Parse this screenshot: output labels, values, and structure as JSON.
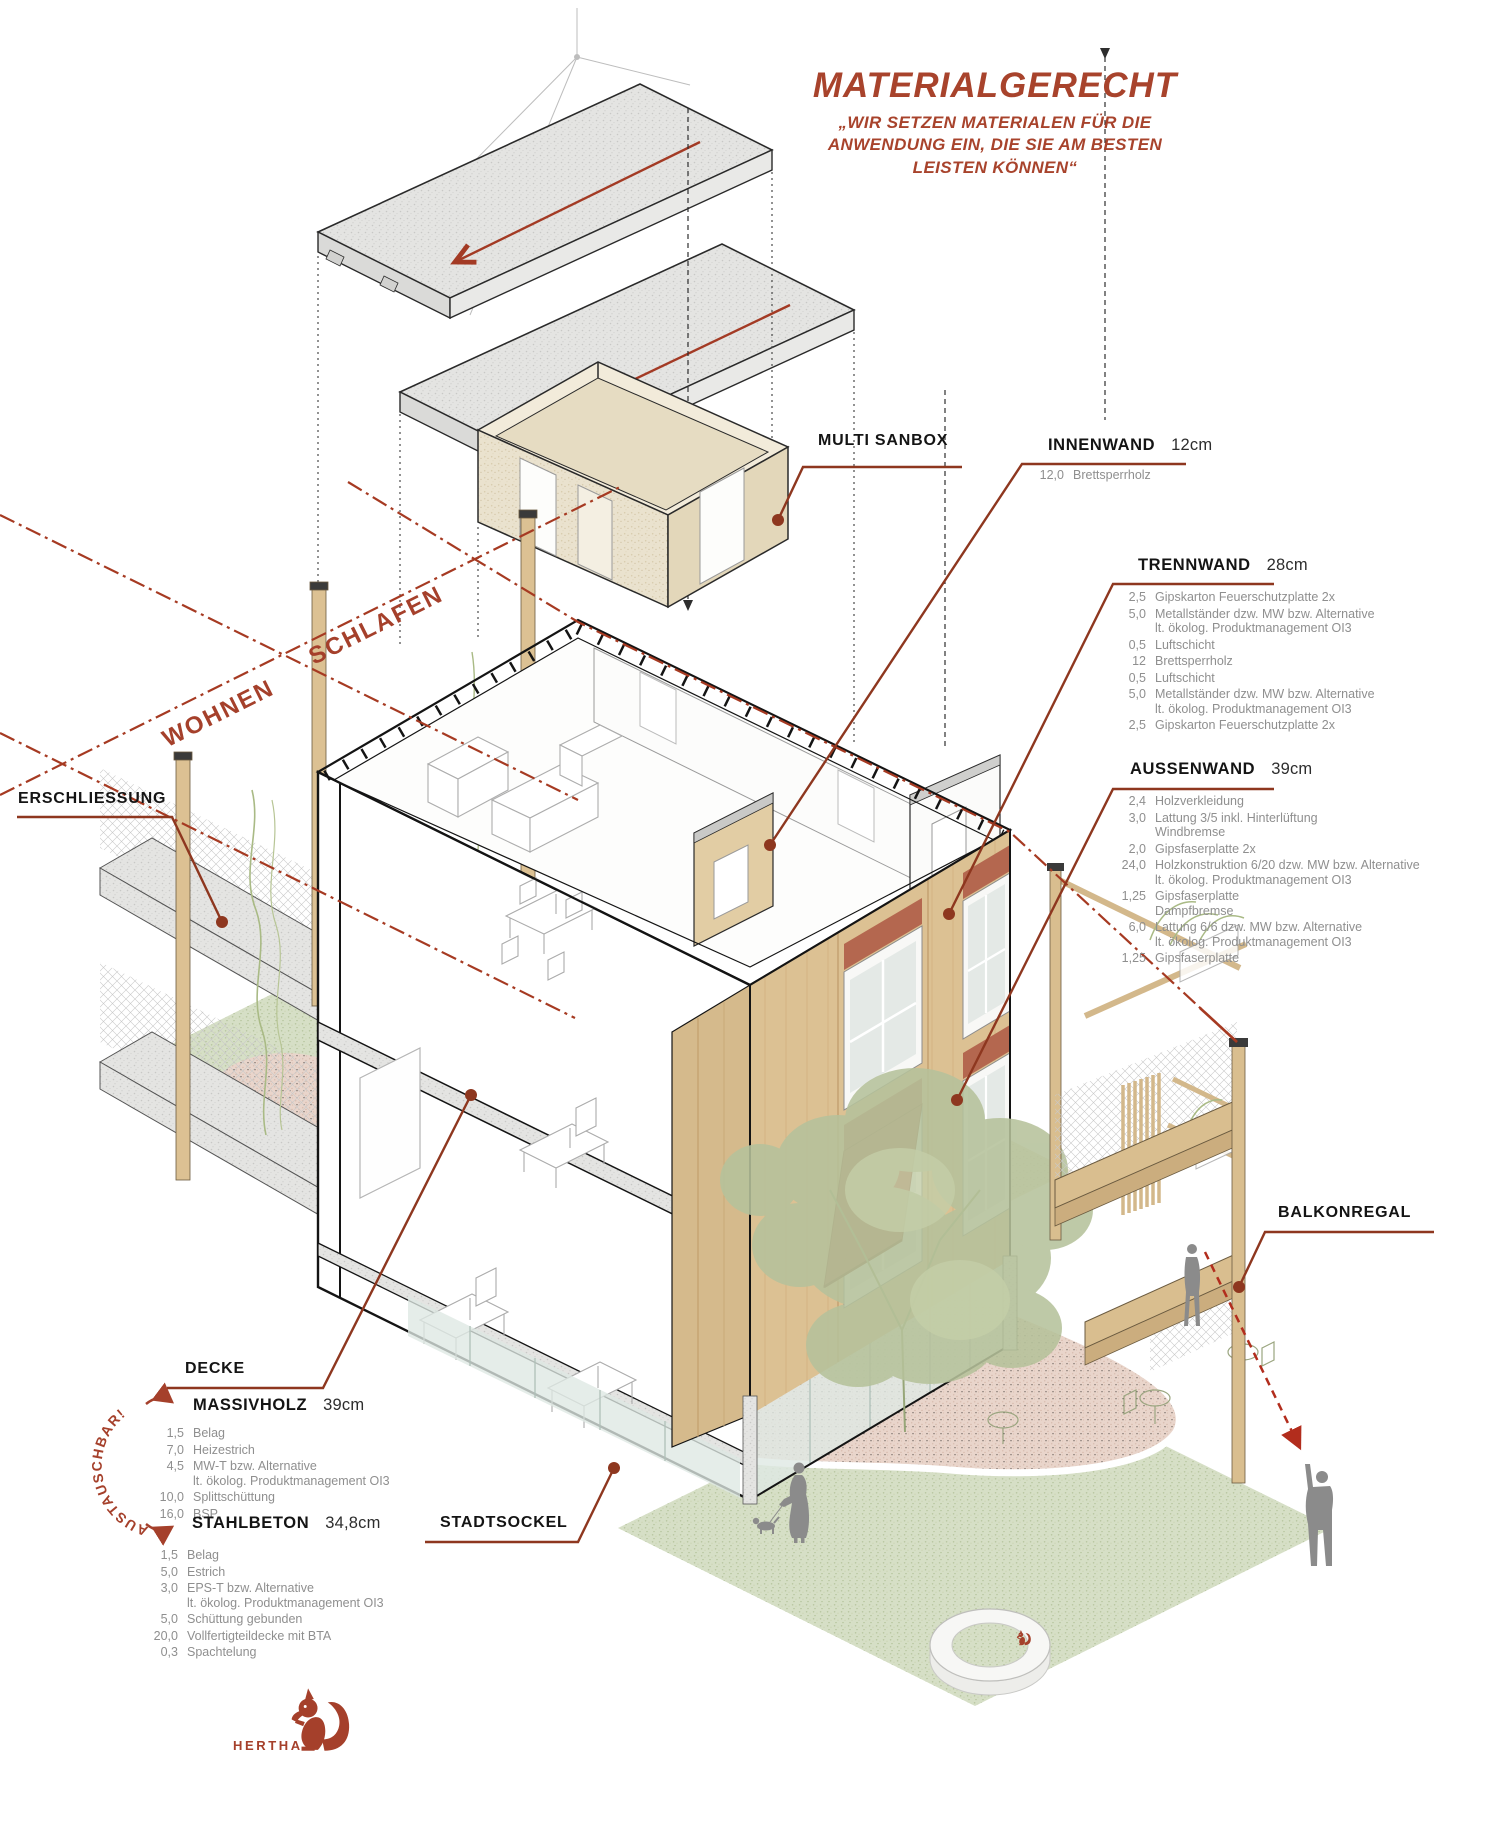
{
  "title": {
    "heading": "MATERIALGERECHT",
    "quote_lines": [
      "„WIR SETZEN MATERIALEN FÜR DIE",
      "ANWENDUNG EIN, DIE SIE AM BESTEN",
      "LEISTEN KÖNNEN“"
    ]
  },
  "zones": {
    "wohnen": "WOHNEN",
    "schlafen": "SCHLAFEN"
  },
  "labels": {
    "erschliessung": "ERSCHLIESSUNG",
    "multi_sanbox": "MULTI SANBOX",
    "balkonregal": "BALKONREGAL",
    "decke": "DECKE",
    "stadtsockel": "STADTSOCKEL",
    "austauschbar": "AUSTAUSCHBAR!",
    "hertha": "HERTHA"
  },
  "walls": {
    "innenwand": {
      "name": "INNENWAND",
      "thickness": "12cm",
      "layers": [
        {
          "v": "12,0",
          "t": "Brettsperrholz"
        }
      ]
    },
    "trennwand": {
      "name": "TRENNWAND",
      "thickness": "28cm",
      "layers": [
        {
          "v": "2,5",
          "t": "Gipskarton Feuerschutzplatte 2x"
        },
        {
          "v": "5,0",
          "t": "Metallständer dzw. MW bzw. Alternative\nlt. ökolog. Produktmanagement OI3"
        },
        {
          "v": "0,5",
          "t": "Luftschicht"
        },
        {
          "v": "12",
          "t": "Brettsperrholz"
        },
        {
          "v": "0,5",
          "t": "Luftschicht"
        },
        {
          "v": "5,0",
          "t": "Metallständer dzw. MW bzw. Alternative\nlt. ökolog. Produktmanagement OI3"
        },
        {
          "v": "2,5",
          "t": "Gipskarton Feuerschutzplatte 2x"
        }
      ]
    },
    "aussenwand": {
      "name": "AUSSENWAND",
      "thickness": "39cm",
      "layers": [
        {
          "v": "2,4",
          "t": "Holzverkleidung"
        },
        {
          "v": "3,0",
          "t": "Lattung 3/5 inkl. Hinterlüftung\nWindbremse"
        },
        {
          "v": "2,0",
          "t": "Gipsfaserplatte 2x"
        },
        {
          "v": "24,0",
          "t": "Holzkonstruktion 6/20 dzw. MW bzw. Alternative\nlt. ökolog. Produktmanagement OI3"
        },
        {
          "v": "1,25",
          "t": "Gipsfaserplatte\nDampfbremse"
        },
        {
          "v": "6,0",
          "t": "Lattung 6/6 dzw. MW bzw. Alternative\nlt. ökolog. Produktmanagement OI3"
        },
        {
          "v": "1,25",
          "t": "Gipsfaserplatte"
        }
      ]
    }
  },
  "floors": {
    "massivholz": {
      "name": "MASSIVHOLZ",
      "thickness": "39cm",
      "layers": [
        {
          "v": "1,5",
          "t": "Belag"
        },
        {
          "v": "7,0",
          "t": "Heizestrich"
        },
        {
          "v": "4,5",
          "t": "MW-T bzw. Alternative\nlt. ökolog. Produktmanagement OI3"
        },
        {
          "v": "10,0",
          "t": "Splittschüttung"
        },
        {
          "v": "16,0",
          "t": "BSP"
        }
      ]
    },
    "stahlbeton": {
      "name": "STAHLBETON",
      "thickness": "34,8cm",
      "layers": [
        {
          "v": "1,5",
          "t": "Belag"
        },
        {
          "v": "5,0",
          "t": "Estrich"
        },
        {
          "v": "3,0",
          "t": "EPS-T bzw. Alternative\nlt. ökolog. Produktmanagement OI3"
        },
        {
          "v": "5,0",
          "t": "Schüttung gebunden"
        },
        {
          "v": "20,0",
          "t": "Vollfertigteildecke mit BTA"
        },
        {
          "v": "0,3",
          "t": "Spachtelung"
        }
      ]
    }
  },
  "colors": {
    "accent": "#A8432C",
    "leader": "#8E371F",
    "dashline": "#A63A22",
    "wood": "#DCC193",
    "terracotta": "#B4674F",
    "concrete": "#E4E4E2",
    "grass": "#D6DFC6",
    "pink": "#E9D5CB",
    "glass": "#DEE8E3",
    "figure": "#8B8B8B"
  }
}
